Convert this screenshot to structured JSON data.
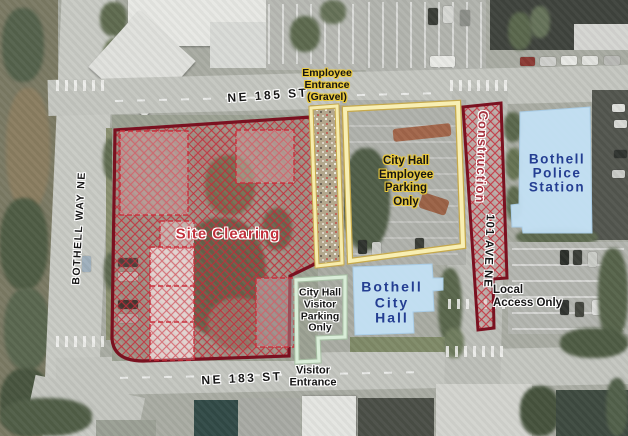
{
  "streets": {
    "ne_185_st": "NE 185 ST",
    "ne_183_st": "NE 183 ST",
    "bothell_way_ne": "BOTHELL WAY NE",
    "ave_101_ne": "101 AVE NE"
  },
  "areas": {
    "site_clearing": "Site Clearing",
    "construction": "Construction",
    "employee_parking": "City Hall\nEmployee\nParking\nOnly",
    "visitor_parking": "City Hall\nVisitor\nParking\nOnly",
    "local_access": "Local\nAccess Only"
  },
  "entrances": {
    "employee_entrance": "Employee\nEntrance\n(Gravel)",
    "visitor_entrance": "Visitor\nEntrance"
  },
  "buildings": {
    "police_station": "Bothell\nPolice\nStation",
    "city_hall": "Bothell\nCity\nHall"
  },
  "colors": {
    "site_border": "#7a1120",
    "hatch_red": "#c42a38",
    "label_red": "#b52e3a",
    "building_fill": "#c3e0f4",
    "building_label_blue": "#243e92",
    "employee_outline_yellow": "#f8efb4",
    "visitor_outline_green": "#d9edd8",
    "halo_yellow": "#e8c83e"
  }
}
